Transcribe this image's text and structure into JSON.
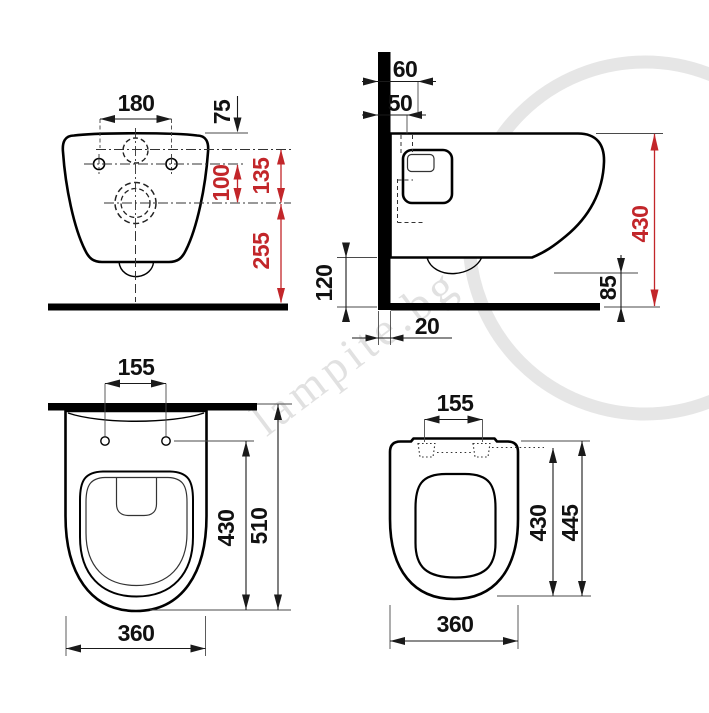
{
  "watermark": {
    "text": "lampite.bg"
  },
  "colors": {
    "dimension_red": "#c2262a",
    "line_black": "#111111",
    "watermark_gray": "#c9c9c9"
  },
  "front_view": {
    "dims": {
      "hole_spacing": "180",
      "top_to_inlet": "75",
      "holes_to_outlet": "100",
      "inlet_to_outlet": "135",
      "outlet_to_floor": "255"
    }
  },
  "side_view": {
    "dims": {
      "inlet_depth": "60",
      "connection_depth": "50",
      "under_clearance": "120",
      "wall_thickness": "20",
      "outlet_height": "85",
      "total_height": "430"
    }
  },
  "top_view_bowl": {
    "dims": {
      "seat_hole_spacing": "155",
      "wall_to_front_holes": "430",
      "total_depth": "510",
      "width": "360"
    }
  },
  "top_view_seat": {
    "dims": {
      "hinge_spacing": "155",
      "seat_depth": "430",
      "total_depth": "445",
      "width": "360"
    }
  }
}
